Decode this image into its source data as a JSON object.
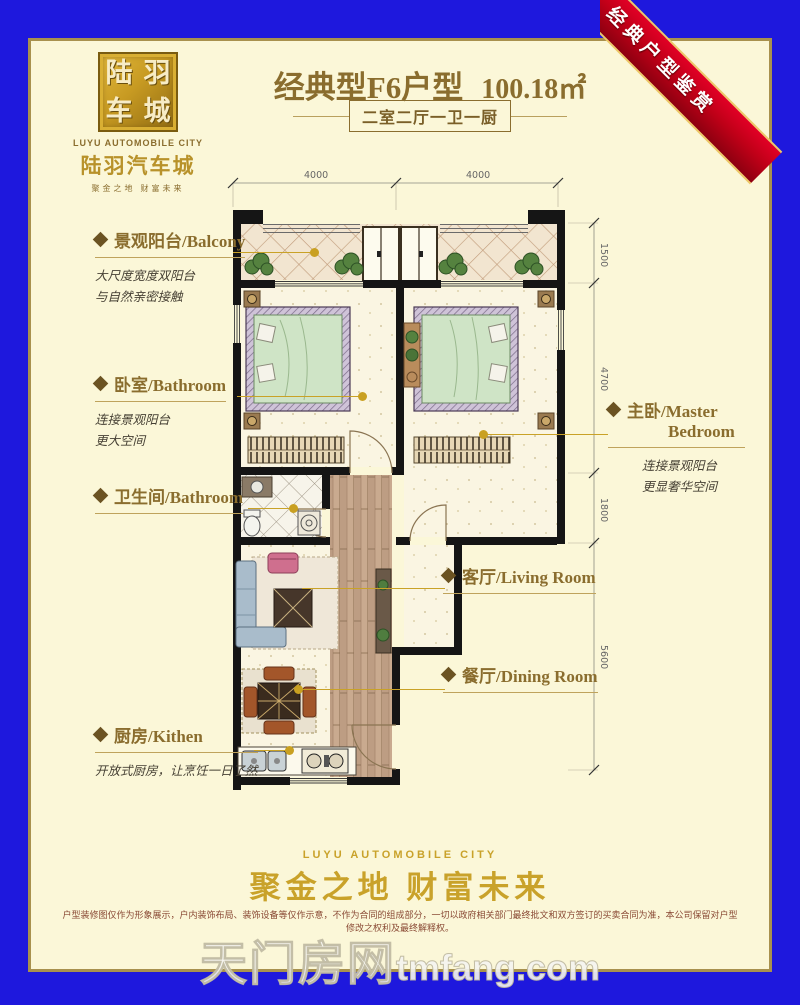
{
  "colors": {
    "border_blue": "#1e18dd",
    "panel_cream": "#fbf7d8",
    "panel_gold_border": "#a8914e",
    "brand_gold": "#c9a22a",
    "label_brown": "#8a6d2e",
    "ribbon_red": "#c00018",
    "leader_gold": "#c9a021",
    "wall_black": "#151515"
  },
  "logo": {
    "seal": [
      "陆",
      "羽",
      "车",
      "城"
    ],
    "en": "LUYU AUTOMOBILE CITY",
    "cn": "陆羽汽车城",
    "slogan": "聚金之地 财富未来"
  },
  "header": {
    "type_name": "经典型F6户型",
    "area": "100.18㎡",
    "layout_spec": "二室二厅一卫一厨"
  },
  "ribbon": {
    "text": "经典户型鉴赏"
  },
  "plan": {
    "dims_top": [
      "4000",
      "4000"
    ],
    "dims_right": [
      "1500",
      "4700",
      "1800",
      "5600"
    ]
  },
  "labels": {
    "balcony": {
      "title": "景观阳台/Balcony",
      "desc1": "大尺度宽度双阳台",
      "desc2": "与自然亲密接触"
    },
    "bedroom": {
      "title": "卧室/Bathroom",
      "desc1": "连接景观阳台",
      "desc2": "更大空间"
    },
    "bathroom": {
      "title": "卫生间/Bathroom"
    },
    "kitchen": {
      "title": "厨房/Kithen",
      "desc": "开放式厨房，让烹饪一日了然"
    },
    "master": {
      "title_line1": "主卧/Master",
      "title_line2": "Bedroom",
      "desc1": "连接景观阳台",
      "desc2": "更显奢华空间"
    },
    "living": {
      "title": "客厅/Living Room"
    },
    "dining": {
      "title": "餐厅/Dining Room"
    }
  },
  "footer": {
    "en": "LUYU AUTOMOBILE CITY",
    "cn": "聚金之地 财富未来",
    "disclaimer": "户型装修图仅作为形象展示，户内装饰布局、装饰设备等仅作示意，不作为合同的组成部分，一切以政府相关部门最终批文和双方签订的买卖合同为准，本公司保留对户型修改之权利及最终解释权。",
    "watermark_cn": "天门房网",
    "watermark_en": "tmfang.com"
  }
}
